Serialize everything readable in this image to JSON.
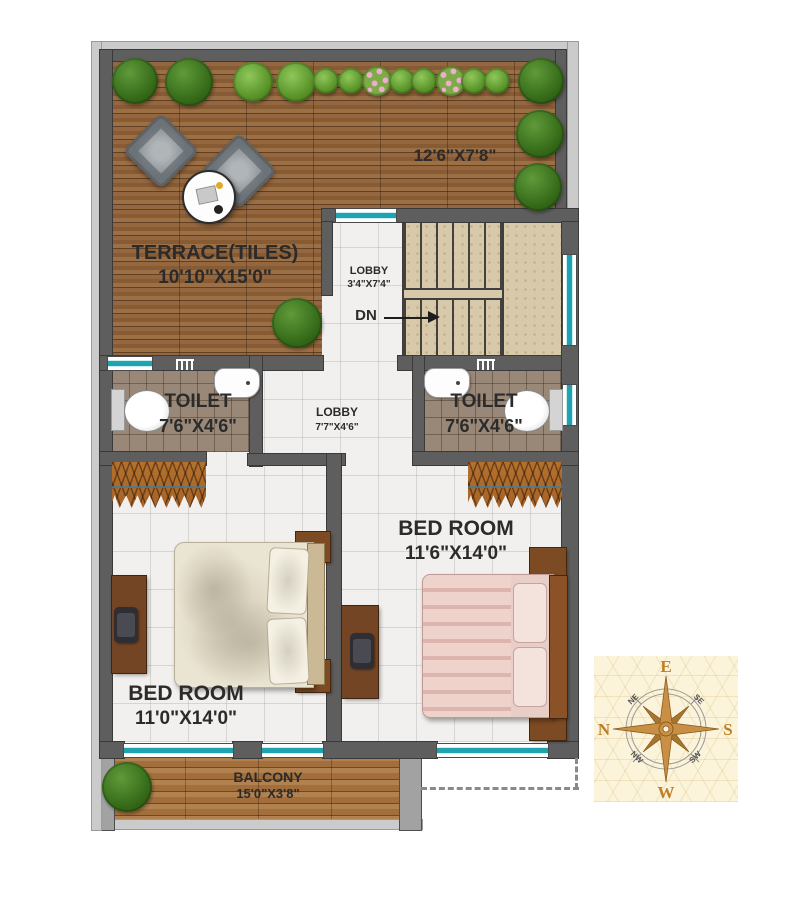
{
  "floorplan": {
    "terrace": {
      "label": "TERRACE(TILES)",
      "dimensions": "10'10\"X15'0\"",
      "upper_dimensions": "12'6\"X7'8\""
    },
    "upper_lobby": {
      "label": "LOBBY",
      "dimensions": "3'4\"X7'4\""
    },
    "stairs": {
      "down_label": "DN"
    },
    "toilet_left": {
      "label": "TOILET",
      "dimensions": "7'6\"X4'6\""
    },
    "middle_lobby": {
      "label": "LOBBY",
      "dimensions": "7'7\"X4'6\""
    },
    "toilet_right": {
      "label": "TOILET",
      "dimensions": "7'6\"X4'6\""
    },
    "bedroom_left": {
      "label": "BED ROOM",
      "dimensions": "11'0\"X14'0\""
    },
    "bedroom_right": {
      "label": "BED ROOM",
      "dimensions": "11'6\"X14'0\""
    },
    "balcony": {
      "label": "BALCONY",
      "dimensions": "15'0\"X3'8\""
    }
  },
  "compass": {
    "north": "N",
    "east": "E",
    "south": "S",
    "west": "W",
    "northeast": "NE",
    "southeast": "SE",
    "southwest": "SW",
    "northwest": "NW"
  },
  "colors": {
    "wall": "#5e5e5e",
    "parapet": "#cbcbcb",
    "terrace_wood": "#8a5c32",
    "balcony_wood": "#a8753f",
    "toilet_tile": "#998878",
    "stair_stone": "#d8c9aa",
    "floor_tile": "#f1f0ee",
    "window_glass": "#1fa3b0",
    "wardrobe": "#b4702c",
    "compass_gold": "#c99045",
    "label_text": "#2b2b2b"
  }
}
